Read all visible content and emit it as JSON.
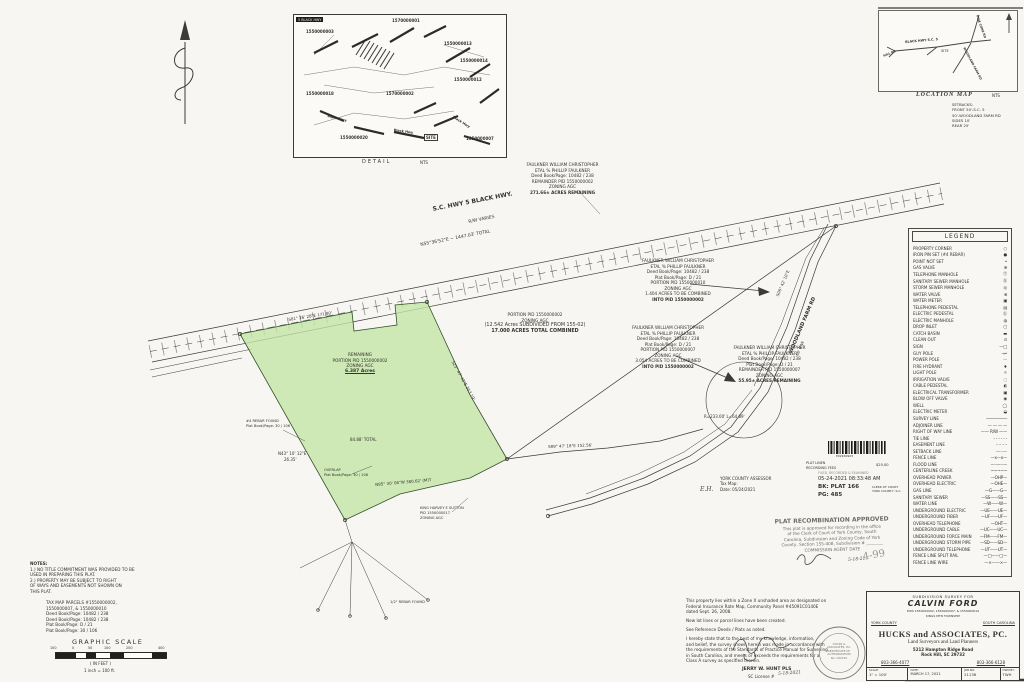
{
  "detail_inset": {
    "chip": "5 BLACK HWY",
    "caption": "DETAIL",
    "scale_note": "NTS",
    "parcel_labels": [
      "1570000001",
      "1550000003",
      "1550000013",
      "1550000014",
      "1550000012",
      "1570000002",
      "1550000018",
      "1550000020",
      "1550000007"
    ],
    "site": "SITE",
    "road_a": "Black Hwy",
    "road_b": "Black Hwy",
    "road_c": "Black Hwy"
  },
  "location_map": {
    "caption": "LOCATION MAP",
    "scale_note": "NTS",
    "site": "SITE",
    "road_main": "BLACK HWY S.C. 5",
    "road_ne": "PINE CONE RD",
    "road_south": "WOODLAND FARM RD",
    "road_w": "HILL RD"
  },
  "setbacks": {
    "lines": [
      "SETBACKS:",
      "FRONT 50'-S.C. 5",
      "50'-WOODLAND FARM RD",
      "SIDES 10'",
      "REAR 25'"
    ]
  },
  "legend": {
    "title": "LEGEND",
    "items": [
      {
        "label": "PROPERTY CORNER",
        "symbol": "○"
      },
      {
        "label": "IRON PIN SET (#4 REBAR)",
        "symbol": "●"
      },
      {
        "label": "POINT NOT SET",
        "symbol": "•"
      },
      {
        "label": "GAS VALVE",
        "symbol": "⊕"
      },
      {
        "label": "TELEPHONE MANHOLE",
        "symbol": "Ⓣ"
      },
      {
        "label": "SANITARY SEWER MANHOLE",
        "symbol": "Ⓢ"
      },
      {
        "label": "STORM SEWER MANHOLE",
        "symbol": "◎"
      },
      {
        "label": "WATER VALVE",
        "symbol": "⊗"
      },
      {
        "label": "WATER METER",
        "symbol": "▣"
      },
      {
        "label": "TELEPHONE PEDESTAL",
        "symbol": "▤"
      },
      {
        "label": "ELECTRIC PEDESTAL",
        "symbol": "Ⓔ"
      },
      {
        "label": "ELECTRIC MANHOLE",
        "symbol": "◍"
      },
      {
        "label": "DROP INLET",
        "symbol": "▢"
      },
      {
        "label": "CATCH BASIN",
        "symbol": "▬"
      },
      {
        "label": "CLEAN OUT",
        "symbol": "⊙"
      },
      {
        "label": "SIGN",
        "symbol": "—□"
      },
      {
        "label": "GUY POLE",
        "symbol": "→•"
      },
      {
        "label": "POWER POLE",
        "symbol": "-◦"
      },
      {
        "label": "FIRE HYDRANT",
        "symbol": "♦"
      },
      {
        "label": "LIGHT POLE",
        "symbol": "☼"
      },
      {
        "label": "IRRIGATION VALVE",
        "symbol": "◌"
      },
      {
        "label": "CABLE PEDESTAL",
        "symbol": "◐"
      },
      {
        "label": "ELECTRICAL TRANSFORMER",
        "symbol": "▣"
      },
      {
        "label": "BLOW OFF VALVE",
        "symbol": "◉"
      },
      {
        "label": "WELL",
        "symbol": "◯"
      },
      {
        "label": "ELECTRIC METER",
        "symbol": "◒"
      },
      {
        "label": "SURVEY LINE",
        "symbol": "─────────"
      },
      {
        "label": "ADJOINER LINE",
        "symbol": "— — — —"
      },
      {
        "label": "RIGHT OF WAY LINE",
        "symbol": "—— R/W ——"
      },
      {
        "label": "TIE LINE",
        "symbol": "- - - - - -"
      },
      {
        "label": "EASEMENT LINE",
        "symbol": "– – – –"
      },
      {
        "label": "SETBACK LINE",
        "symbol": "··········"
      },
      {
        "label": "FENCE LINE",
        "symbol": "—x—x—"
      },
      {
        "label": "FLOOD LINE",
        "symbol": "—··—··—"
      },
      {
        "label": "CENTERLINE CREEK",
        "symbol": "~~~~~"
      },
      {
        "label": "OVERHEAD POWER",
        "symbol": "—OHP—"
      },
      {
        "label": "OVERHEAD ELECTRIC",
        "symbol": "—OHE—"
      },
      {
        "label": "GAS LINE",
        "symbol": "—G——G—"
      },
      {
        "label": "SANITARY SEWER",
        "symbol": "—SS——SS—"
      },
      {
        "label": "WATER LINE",
        "symbol": "—W——W—"
      },
      {
        "label": "UNDERGROUND ELECTRIC",
        "symbol": "—UE——UE—"
      },
      {
        "label": "UNDERGROUND FIBER",
        "symbol": "—UF——UF—"
      },
      {
        "label": "OVERHEAD TELEPHONE",
        "symbol": "—OHT—"
      },
      {
        "label": "UNDERGROUND CABLE",
        "symbol": "—UC——UC—"
      },
      {
        "label": "UNDERGROUND FORCE MAIN",
        "symbol": "—FM——FM—"
      },
      {
        "label": "UNDERGROUND STORM PIPE",
        "symbol": "—SD——SD—"
      },
      {
        "label": "UNDERGROUND TELEPHONE",
        "symbol": "—UT——UT—"
      },
      {
        "label": "FENCE LINE SPLIT RAIL",
        "symbol": "—□——□—"
      },
      {
        "label": "FENCE LINE WIRE",
        "symbol": "—×——×—"
      }
    ]
  },
  "highway": {
    "name": "S.C. HWY 5 BLACK HWY.",
    "rw": "R/W VARIES",
    "bearing": "N55°36'52\"E ~ 1447.03' TOTAL"
  },
  "woodland": {
    "name": "WOODLAND FARM RD",
    "rw": "66' R/W"
  },
  "green_parcel": {
    "line1": "REMAINING",
    "line2": "PORTION PID 1550000002",
    "line3": "ZONING AGC",
    "acres": "6.387 Acres"
  },
  "combined_parcel": {
    "l1": "PORTION PID 1550000002",
    "l2": "ZONING AGC",
    "l3": "(12.542 Acres SUBDIVIDED FROM 155-02)",
    "l4": "17.000 ACRES TOTAL COMBINED"
  },
  "owner_blocks": [
    {
      "lines": [
        "FAULKNER WILLIAM CHRISTOPHER",
        "ETAL % PHILLIP FAULKNER",
        "Deed Book/Page: 10482 / 238",
        "REMAINDER PID 1550000002",
        "ZONING AGC",
        "271.66± ACRES REMAINING"
      ]
    },
    {
      "lines": [
        "FAULKNER WILLIAM CHRISTOPHER",
        "ETAL % PHILLIP FAULKNER",
        "Deed Book/Page: 10482 / 238",
        "Plat Book/Page: D / 21",
        "PORTION PID 1550000010",
        "ZONING AGC",
        "1.404 ACRES TO BE COMBINED",
        "INTO PID 1550000002"
      ]
    },
    {
      "lines": [
        "FAULKNER WILLIAM CHRISTOPHER",
        "ETAL % PHILLIP FAULKNER",
        "Deed Book/Page: 10482 / 238",
        "Plat Book/Page: D / 21",
        "PORTION PID 1550000007",
        "ZONING AGC",
        "3.054 ACRES TO BE COMBINED",
        "INTO PID 1550000002"
      ]
    },
    {
      "lines": [
        "FAULKNER WILLIAM CHRISTOPHER",
        "ETAL % PHILLIP FAULKNER",
        "Deed Book/Page: 10482 / 238",
        "Plat Book/Page: D / 21",
        "REMAINDER PID 1550000007",
        "ZONING AGC",
        "55.95± ACRES REMAINING"
      ]
    }
  ],
  "dim_labels": [
    "S81° 26' 28\"E  171.80'",
    "S25° 47' 42\"E  353.19'",
    "N85° 30' 06\"W  380.62' (M)T",
    "84.88' TOTAL",
    "S89° 47' 18\"E  152.56'",
    "N43° 10' 12\"E",
    "26.35'",
    "S06° 42' 10\"E",
    "R=233.00'  L=64.89'",
    "1/2\" REBAR FOUND"
  ],
  "monuments": {
    "rebar": {
      "lines": [
        "#4 REBAR FOUND",
        "Plat Book/Page: 30 / 106"
      ]
    },
    "overlap": {
      "lines": [
        "OVERLAP",
        "Plat Book/Page: 30 / 106"
      ]
    },
    "king": {
      "lines": [
        "KING HARVEY E SUTTON",
        "PID 1550000017",
        "ZONING AGC"
      ]
    }
  },
  "assessor": {
    "lines": [
      "YORK COUNTY ASSESSOR",
      "Tax Map:",
      "Date: 05/24/2021"
    ]
  },
  "recording": {
    "barcode_number": "P02160923",
    "fee_line1": "PLAT LINEN",
    "fee_line2": "RECORDING FEES",
    "fee_amount": "$25.00",
    "faint": "FILED, RECORDED & EXAMINED",
    "datetime": "05-24-2021 08:33:48 AM",
    "book": "BK: PLAT 166",
    "page": "PG: 485",
    "clerk1": "CLERK OF COURT",
    "clerk2": "YORK COUNTY, S.C."
  },
  "approval_stamp": {
    "title": "PLAT RECOMBINATION APPROVED",
    "lines": [
      "This plat is approved for recording in the office",
      "of the Clerk of Court of York County, South",
      "Carolina, Subdivision and Zoning Code of York",
      "County, Section 155-408, Subdivision # ________",
      "COMMISSION AGENT                    DATE"
    ],
    "hand_date": "5-18-21"
  },
  "handwriting": {
    "initials": "E.H.",
    "pencil": "4-99"
  },
  "certification": {
    "lines": [
      "This property lies within a Zone X unshaded area as designated on",
      "Federal Insurance Rate Map, Community Panel #45091C0140E",
      "dated Sept. 26, 2008.",
      "",
      "New lot lines or parcel lines have been created.",
      "",
      "See Reference Deeds / Plats as noted.",
      "",
      "I hereby state that to the best of my knowledge, information,",
      "and belief, the survey shown herein was made in accordance with",
      "the requirements of the Standards of Practice Manual for Surveying",
      "in South Carolina, and meets or exceeds the requirements for a",
      "Class A  survey as specified therein."
    ]
  },
  "signature": {
    "name": "JERRY W. HUNT PLS",
    "license": "SC License #",
    "hand_date": "5-18-2021"
  },
  "seal": {
    "center": [
      "HUCKS &",
      "ASSOCIATES, P.C.",
      "CERTIFICATE OF",
      "AUTHORIZATION",
      "No. C02232"
    ]
  },
  "notes": {
    "title": "NOTES:",
    "lines": [
      "1.)  NO TITLE COMMITMENT WAS PROVIDED TO BE",
      "       USED IN PREPARING THIS PLAT.",
      "2.)  PROPERTY MAY BE SUBJECT TO RIGHT",
      "       OF WAYS AND EASEMENTS NOT SHOWN ON",
      "       THIS PLAT."
    ]
  },
  "tax_block": {
    "lines": [
      "TAX MAP PARCELS #1550000002,",
      "1550000007, & 1550000010",
      "Deed Book/Page: 10482 / 238",
      "Deed Book/Page: 10482 / 238",
      "Plat Book/Page: D / 21",
      "Plat Book/Page: 30 / 106"
    ]
  },
  "graphic_scale": {
    "title": "GRAPHIC SCALE",
    "ticks": [
      "100",
      "0",
      "50",
      "100",
      "200",
      "400"
    ],
    "units": "( IN FEET )",
    "ratio": "1 inch = 100 ft."
  },
  "title_block": {
    "subtitle": "SUBDIVISION SURVEY FOR",
    "client": "CALVIN FORD",
    "pids": "PIDS 1550000002, 1550000007, & 1550000010",
    "township": "KINGS MTN TOWNSHIP",
    "county": "YORK COUNTY",
    "state": "SOUTH CAROLINA",
    "firm": "HUCKS and ASSOCIATES, PC.",
    "firm_tag": "Land Surveyors and Land Planners",
    "address1": "5212 Hampton Ridge Road",
    "address2": "Rock Hill, SC  29732",
    "phone1": "803-366-4077",
    "phone2": "803-366-6128",
    "scale_label": "SCALE:",
    "scale": "1\" = 100'",
    "date_label": "DATE:",
    "date": "MARCH 17, 2021",
    "job_label": "JOB NO:",
    "job": "21136",
    "dwn_label": "DWN BY:",
    "dwn": "TWH"
  }
}
